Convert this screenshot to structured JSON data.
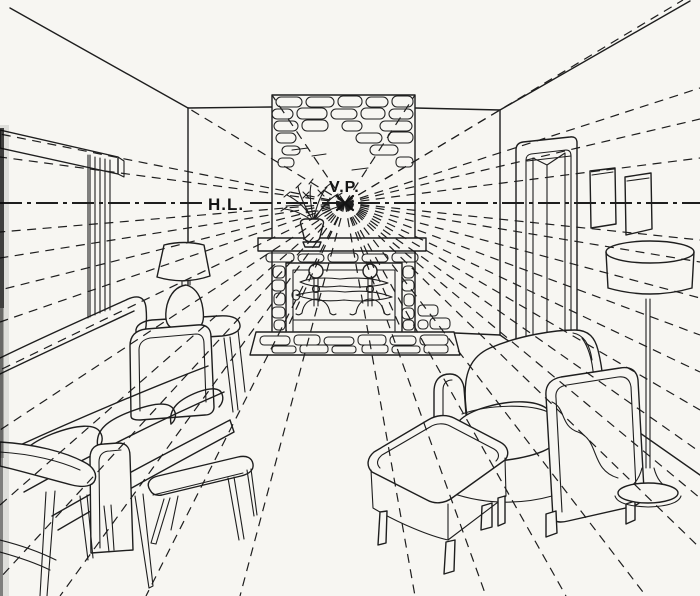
{
  "labels": {
    "horizon_line": "H.L.",
    "vanishing_point": "V.P."
  },
  "colors": {
    "ink": "#1e1e1e",
    "paper": "#f7f6f2",
    "edge_shadow": "#0a0a0a"
  },
  "scene": {
    "type": "one-point perspective drawing of a living room interior",
    "objects": [
      "horizon-line",
      "vanishing-point-mark",
      "perspective-guide-rays",
      "window",
      "window-valance",
      "sofa",
      "seat-cushions",
      "end-table",
      "table-lamp",
      "round-side-table",
      "bench",
      "fireplace-chimney",
      "stone-masonry",
      "mantel-shelf",
      "potted-plant",
      "firebox",
      "andirons",
      "logs",
      "hearth",
      "door",
      "picture-frames",
      "armchair",
      "ottoman",
      "floor-lamp",
      "lamp-cord"
    ]
  }
}
